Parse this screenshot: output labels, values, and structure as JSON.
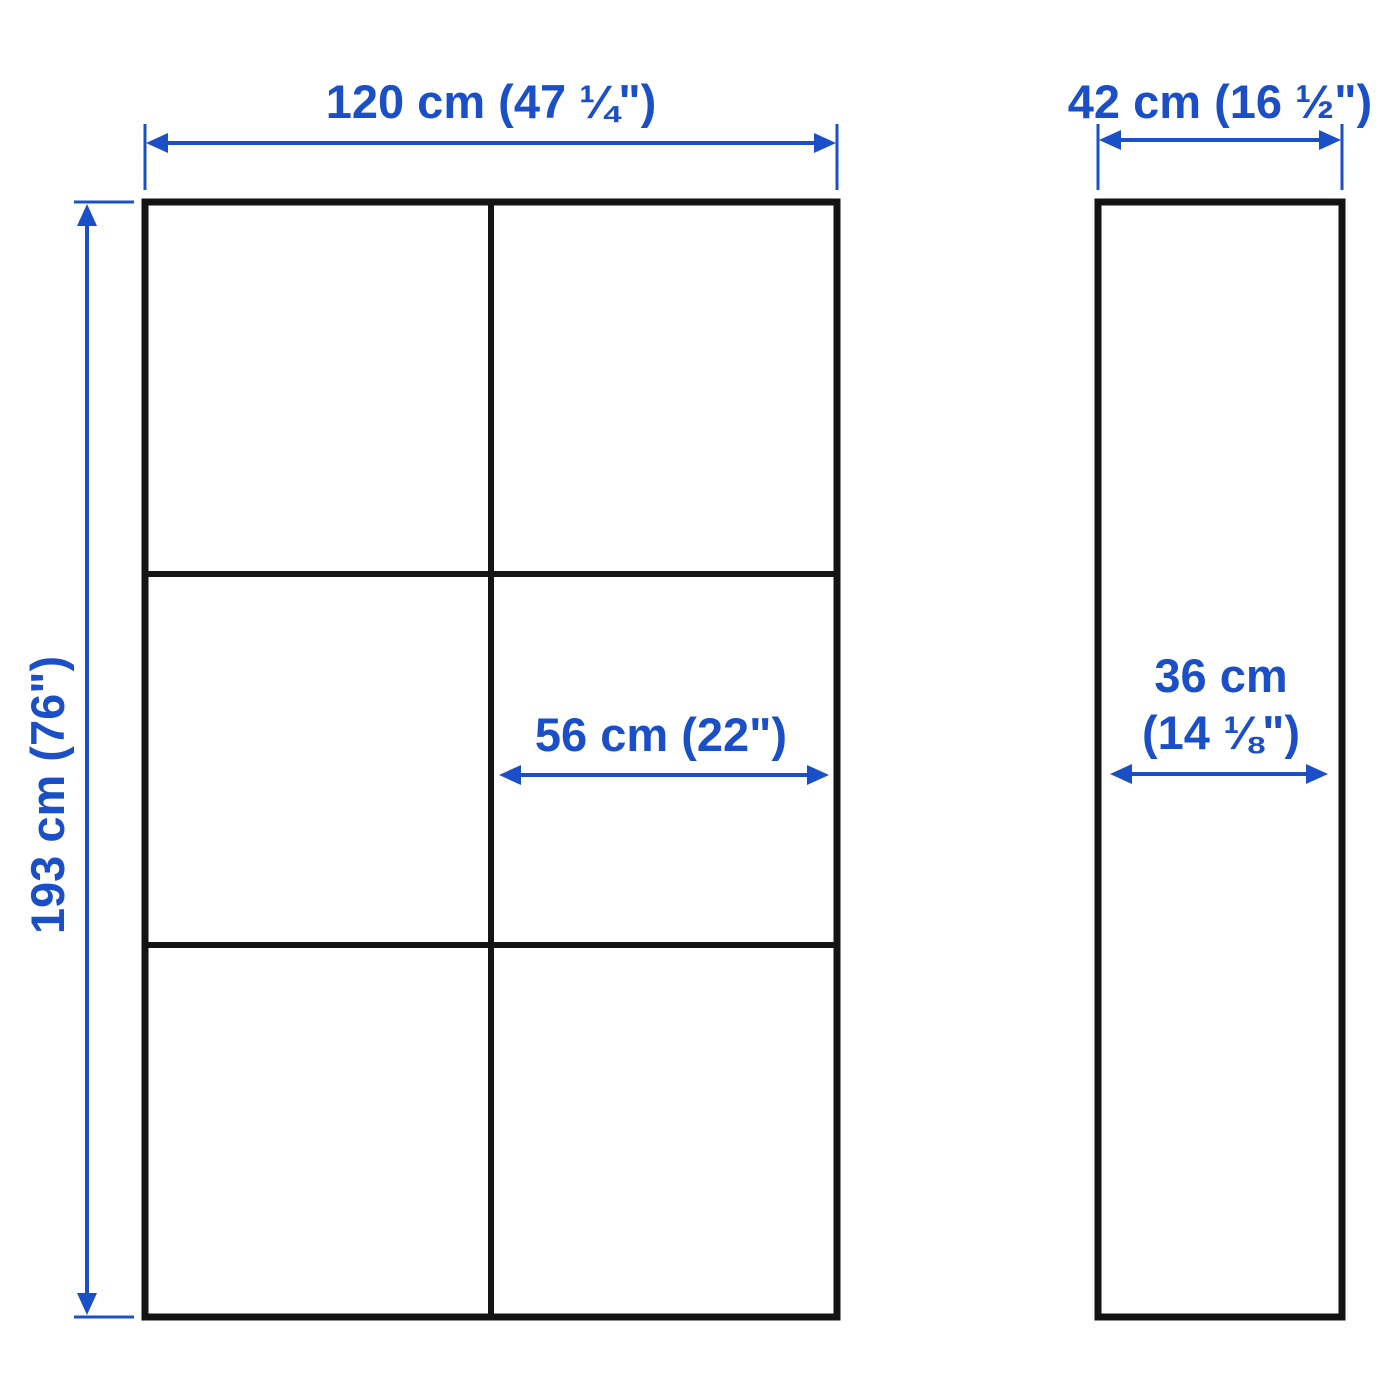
{
  "colors": {
    "dimension_blue": "#1b4fc7",
    "outline_black": "#141414",
    "background": "#ffffff"
  },
  "diagram": {
    "front_view": {
      "overall_width_label": "120 cm (47 ¼\")",
      "overall_height_label": "193 cm (76\")",
      "compartment_width_label": "56 cm (22\")"
    },
    "side_view": {
      "overall_depth_label": "42 cm (16 ½\")",
      "inner_depth_label_line1": "36 cm",
      "inner_depth_label_line2": "(14 ⅛\")"
    }
  }
}
